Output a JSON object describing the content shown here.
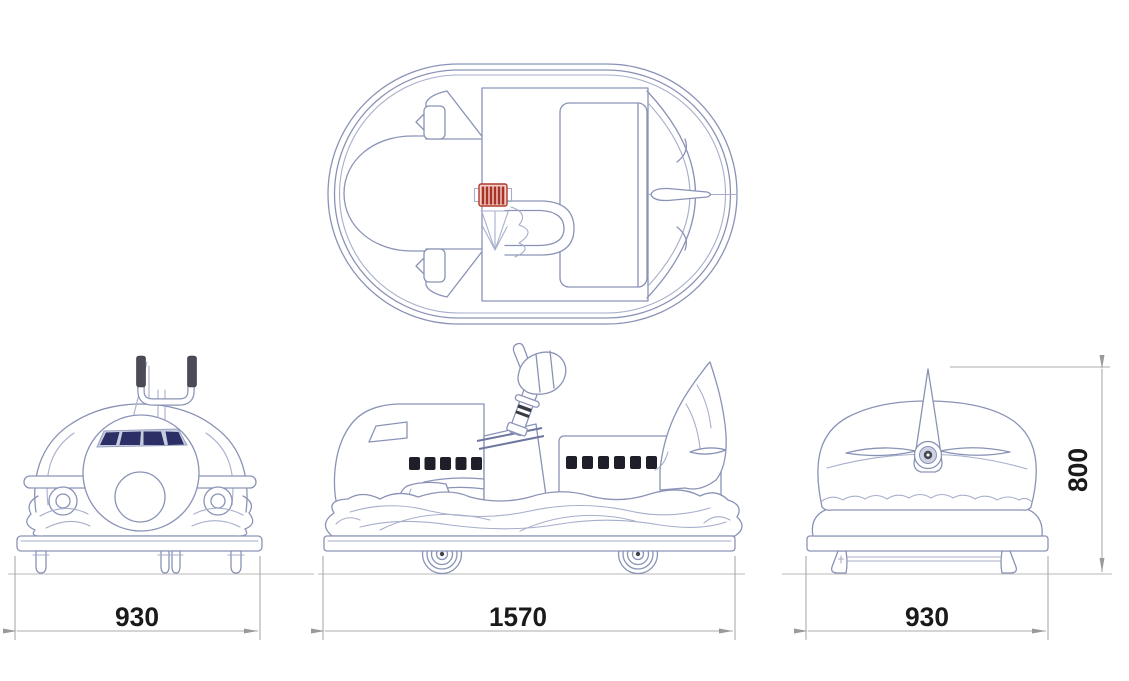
{
  "dimensions": {
    "front_width": "930",
    "side_length": "1570",
    "rear_width": "930",
    "overall_height": "800"
  },
  "colors": {
    "background": "#FFFFFF",
    "line": "#8A93B6",
    "line_light": "#A6AECB",
    "dim_line": "#ABABAB",
    "dim_text": "#1A1A1A",
    "windshield": "#2B2F66",
    "windshield_frame": "#C7CCE0",
    "window": "#1F1F2A",
    "grip_red_border": "#B03A2E",
    "grip_red_stripe": "#A93226",
    "grip_red_fill": "#F2CFC9",
    "handle_grip": "#4B4B57",
    "hub_dark": "#4A4A55",
    "hub_mid": "#CDD2E2"
  }
}
